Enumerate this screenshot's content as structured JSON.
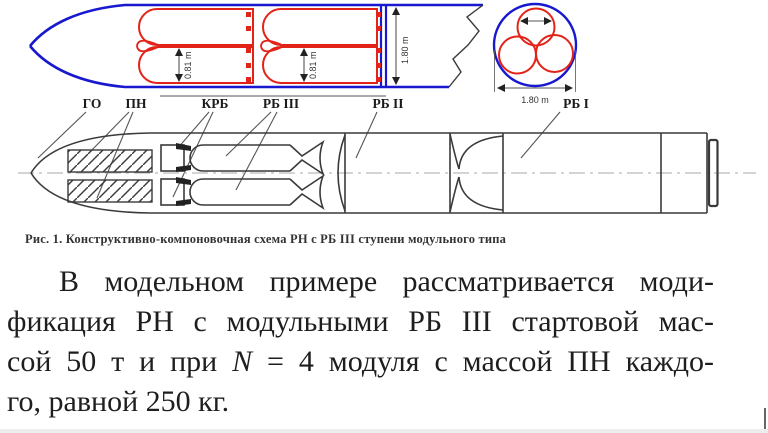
{
  "figure": {
    "side_view": {
      "dim_module_diameter": "0.81 m",
      "dim_fairing_diameter": "1.80 m"
    },
    "cross_section": {
      "dim_diameter": "1.80 m"
    },
    "labels": {
      "go": "ГО",
      "pn": "ПН",
      "krb": "КРБ",
      "rb3": "РБ III",
      "rb2": "РБ II",
      "rb1": "РБ I"
    },
    "colors": {
      "fairing_blue": "#1818cf",
      "module_red": "#e22318",
      "drawing_black": "#3a3a3a"
    }
  },
  "caption": "Рис. 1. Конструктивно-компоновочная схема РН с РБ III ступени модульного типа",
  "paragraph": {
    "line1": "В модельном примере рассматривается моди-",
    "line2": "фикация РН с модульными РБ III стартовой мас-",
    "line3_pre": "сой 50 т и при ",
    "line3_var": "N",
    "line3_post": " = 4 модуля с массой ПН каждо-",
    "line4": "го, равной 250 кг."
  }
}
